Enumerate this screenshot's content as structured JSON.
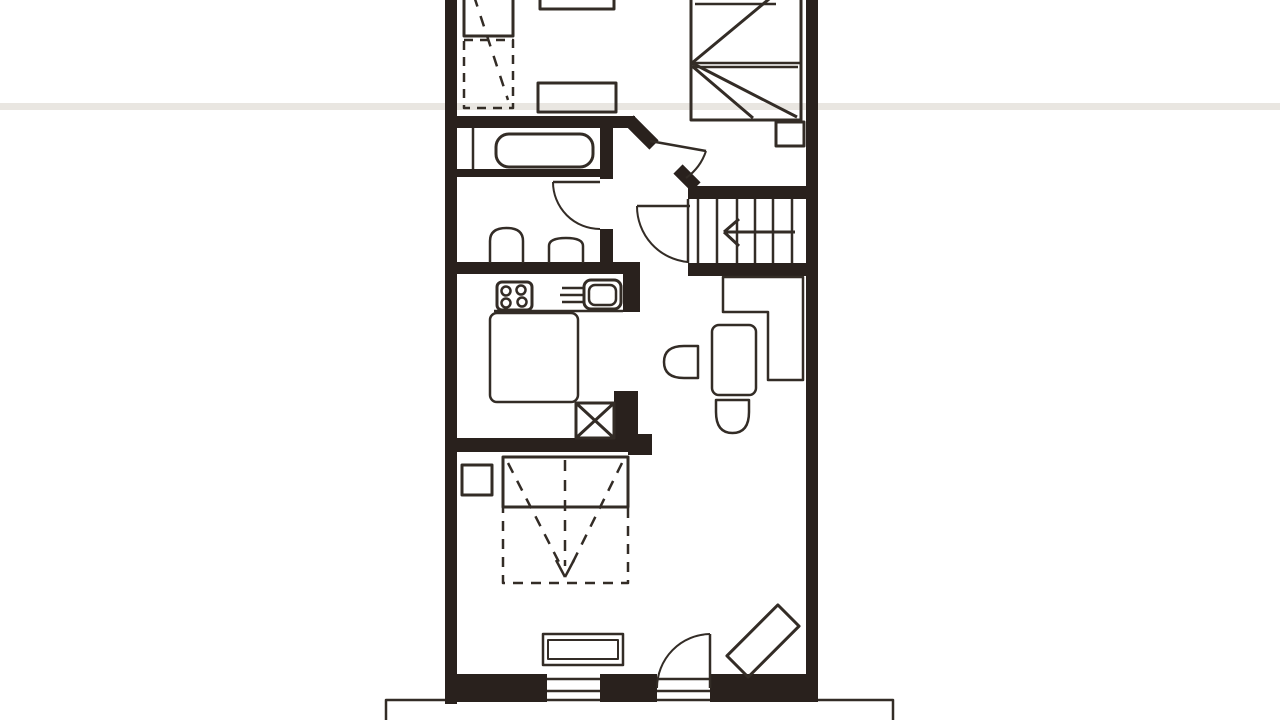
{
  "document": {
    "kind": "scanned hand-drawn floor plan, upper storey, no text labels",
    "rooms": [
      "bedroom-top-left",
      "bedroom-top-right",
      "bathroom",
      "wc",
      "kitchen",
      "stair-hall",
      "dining-nook",
      "bedroom-lower",
      "balcony"
    ]
  },
  "floorplan": {
    "canvas": {
      "width": 1280,
      "height": 720,
      "background": "#ffffff"
    },
    "style": {
      "wall": "#29211d",
      "ink": "#332c26",
      "artifact": "#e9e6e1"
    },
    "shapes": [
      {
        "name": "scan-artifact-band",
        "type": "rect",
        "x": 0,
        "y": 103,
        "width": 1280,
        "height": 7,
        "fill": "#e9e6e1",
        "stroke": "none"
      },
      {
        "name": "balcony-outline",
        "type": "path",
        "d": "M386,720 L386,700 L893,700 L893,720",
        "w": 2.5
      },
      {
        "name": "left-wall",
        "type": "rect",
        "x": 445,
        "y": 0,
        "width": 12,
        "height": 704,
        "fill": "wall",
        "stroke": "none"
      },
      {
        "name": "right-wall",
        "type": "rect",
        "x": 806,
        "y": 0,
        "width": 12,
        "height": 702,
        "fill": "wall",
        "stroke": "none"
      },
      {
        "name": "top-left-room-bottom-wall",
        "type": "rect",
        "x": 445,
        "y": 116,
        "width": 190,
        "height": 12,
        "fill": "wall",
        "stroke": "none"
      },
      {
        "name": "hall-diagonal-wall-upper",
        "type": "line",
        "x1": 629,
        "y1": 120,
        "x2": 654,
        "y2": 145,
        "w": 13,
        "c": "wall"
      },
      {
        "name": "hall-diagonal-wall-lower",
        "type": "line",
        "x1": 678,
        "y1": 169,
        "x2": 696,
        "y2": 187,
        "w": 13,
        "c": "wall"
      },
      {
        "name": "stairwell-top-wall",
        "type": "rect",
        "x": 688,
        "y": 186,
        "width": 130,
        "height": 13,
        "fill": "wall",
        "stroke": "none"
      },
      {
        "name": "stairwell-bottom-wall",
        "type": "rect",
        "x": 688,
        "y": 263,
        "width": 130,
        "height": 13,
        "fill": "wall",
        "stroke": "none"
      },
      {
        "name": "bathroom-side-wall-upper",
        "type": "rect",
        "x": 600,
        "y": 122,
        "width": 13,
        "height": 57,
        "fill": "wall",
        "stroke": "none"
      },
      {
        "name": "bathroom-side-wall-lower",
        "type": "rect",
        "x": 600,
        "y": 229,
        "width": 13,
        "height": 35,
        "fill": "wall",
        "stroke": "none"
      },
      {
        "name": "tub-base-wall",
        "type": "rect",
        "x": 455,
        "y": 169,
        "width": 146,
        "height": 8,
        "fill": "wall",
        "stroke": "none"
      },
      {
        "name": "wc-kitchen-wall",
        "type": "rect",
        "x": 445,
        "y": 262,
        "width": 195,
        "height": 12,
        "fill": "wall",
        "stroke": "none"
      },
      {
        "name": "kitchen-right-wall-post",
        "type": "rect",
        "x": 623,
        "y": 262,
        "width": 17,
        "height": 50,
        "fill": "wall",
        "stroke": "none"
      },
      {
        "name": "kitchen-bottom-wall",
        "type": "rect",
        "x": 445,
        "y": 438,
        "width": 200,
        "height": 14,
        "fill": "wall",
        "stroke": "none"
      },
      {
        "name": "kitchen-bottom-wall-end",
        "type": "rect",
        "x": 628,
        "y": 434,
        "width": 24,
        "height": 21,
        "fill": "wall",
        "stroke": "none"
      },
      {
        "name": "shaft-side-wall",
        "type": "rect",
        "x": 614,
        "y": 391,
        "width": 24,
        "height": 47,
        "fill": "wall",
        "stroke": "none"
      },
      {
        "name": "bottom-wall-left",
        "type": "rect",
        "x": 447,
        "y": 674,
        "width": 100,
        "height": 28,
        "fill": "wall",
        "stroke": "none"
      },
      {
        "name": "bottom-wall-mid",
        "type": "rect",
        "x": 600,
        "y": 674,
        "width": 57,
        "height": 28,
        "fill": "wall",
        "stroke": "none"
      },
      {
        "name": "bottom-wall-right",
        "type": "rect",
        "x": 710,
        "y": 674,
        "width": 98,
        "height": 28,
        "fill": "wall",
        "stroke": "none"
      },
      {
        "name": "bathroom-divider-line",
        "type": "line",
        "x1": 473,
        "y1": 128,
        "x2": 473,
        "y2": 169,
        "w": 2.5
      },
      {
        "name": "window-south-line1",
        "type": "line",
        "x1": 547,
        "y1": 679,
        "x2": 600,
        "y2": 679,
        "w": 2.5
      },
      {
        "name": "window-south-line2",
        "type": "line",
        "x1": 547,
        "y1": 691,
        "x2": 600,
        "y2": 691,
        "w": 2.5
      },
      {
        "name": "balcony-door-threshold1",
        "type": "line",
        "x1": 657,
        "y1": 679,
        "x2": 710,
        "y2": 679,
        "w": 2.5
      },
      {
        "name": "balcony-door-threshold2",
        "type": "line",
        "x1": 657,
        "y1": 691,
        "x2": 710,
        "y2": 691,
        "w": 2.5
      },
      {
        "name": "stair-tread-1",
        "type": "line",
        "x1": 698,
        "y1": 199,
        "x2": 698,
        "y2": 263,
        "w": 2.5
      },
      {
        "name": "stair-tread-2",
        "type": "line",
        "x1": 717,
        "y1": 199,
        "x2": 717,
        "y2": 263,
        "w": 2.5
      },
      {
        "name": "stair-tread-3",
        "type": "line",
        "x1": 737,
        "y1": 199,
        "x2": 737,
        "y2": 263,
        "w": 2.5
      },
      {
        "name": "stair-tread-4",
        "type": "line",
        "x1": 755,
        "y1": 199,
        "x2": 755,
        "y2": 263,
        "w": 2.5
      },
      {
        "name": "stair-tread-5",
        "type": "line",
        "x1": 773,
        "y1": 199,
        "x2": 773,
        "y2": 263,
        "w": 2.5
      },
      {
        "name": "stair-tread-6",
        "type": "line",
        "x1": 792,
        "y1": 199,
        "x2": 792,
        "y2": 263,
        "w": 2.5
      },
      {
        "name": "stair-left-edge",
        "type": "line",
        "x1": 688,
        "y1": 199,
        "x2": 688,
        "y2": 263,
        "w": 2.5
      },
      {
        "name": "stair-direction-arrow-shaft",
        "type": "line",
        "x1": 795,
        "y1": 232,
        "x2": 724,
        "y2": 232,
        "w": 3
      },
      {
        "name": "stair-arrow-barb-up",
        "type": "line",
        "x1": 724,
        "y1": 232,
        "x2": 739,
        "y2": 219,
        "w": 3
      },
      {
        "name": "stair-arrow-barb-down",
        "type": "line",
        "x1": 724,
        "y1": 232,
        "x2": 739,
        "y2": 246,
        "w": 3
      },
      {
        "name": "wc-door-leaf",
        "type": "line",
        "x1": 553,
        "y1": 182,
        "x2": 600,
        "y2": 182,
        "w": 2.5
      },
      {
        "name": "wc-door-arc",
        "type": "path",
        "d": "M553,182 A47,47 0 0 0 600,229",
        "w": 2
      },
      {
        "name": "stairs-door-leaf",
        "type": "line",
        "x1": 637,
        "y1": 206,
        "x2": 690,
        "y2": 206,
        "w": 2.5
      },
      {
        "name": "stairs-door-arc",
        "type": "path",
        "d": "M637,206 A56,56 0 0 0 688,262",
        "w": 2
      },
      {
        "name": "bedroom-door-leaf",
        "type": "line",
        "x1": 650,
        "y1": 141,
        "x2": 706,
        "y2": 151,
        "w": 2.5
      },
      {
        "name": "bedroom-door-arc",
        "type": "path",
        "d": "M706,151 A54,54 0 0 1 686,178",
        "w": 2
      },
      {
        "name": "balcony-door-leaf",
        "type": "line",
        "x1": 710,
        "y1": 634,
        "x2": 710,
        "y2": 688,
        "w": 2.5
      },
      {
        "name": "balcony-door-arc",
        "type": "path",
        "d": "M710,634 A54,54 0 0 0 657,688",
        "w": 2
      },
      {
        "name": "tl-cabinet",
        "type": "rect",
        "x": 464,
        "y": -8,
        "width": 49,
        "height": 44,
        "w": 3
      },
      {
        "name": "tl-cabinet-dashed",
        "type": "rect",
        "x": 464,
        "y": 40,
        "width": 49,
        "height": 68,
        "w": 2.5,
        "dash": [
          9,
          7
        ]
      },
      {
        "name": "tl-slope-dash-line",
        "type": "line",
        "x1": 474,
        "y1": -4,
        "x2": 508,
        "y2": 100,
        "w": 2.5,
        "dash": [
          11,
          10
        ]
      },
      {
        "name": "tl-top-table",
        "type": "rect",
        "x": 540,
        "y": -18,
        "width": 74,
        "height": 27,
        "w": 3
      },
      {
        "name": "tl-desk",
        "type": "rect",
        "x": 538,
        "y": 83,
        "width": 78,
        "height": 29,
        "w": 3
      },
      {
        "name": "double-bed",
        "type": "rect",
        "x": 691,
        "y": -40,
        "width": 110,
        "height": 160,
        "w": 3
      },
      {
        "name": "double-bed-mid-line1",
        "type": "line",
        "x1": 691,
        "y1": 63,
        "x2": 801,
        "y2": 63,
        "w": 2.5
      },
      {
        "name": "double-bed-mid-line2",
        "type": "line",
        "x1": 691,
        "y1": 67,
        "x2": 798,
        "y2": 67,
        "w": 2.5
      },
      {
        "name": "double-bed-diag-upper",
        "type": "line",
        "x1": 798,
        "y1": -25,
        "x2": 692,
        "y2": 63,
        "w": 3
      },
      {
        "name": "double-bed-diag-lower",
        "type": "line",
        "x1": 692,
        "y1": 63,
        "x2": 797,
        "y2": 117,
        "w": 3
      },
      {
        "name": "double-bed-diag-inner",
        "type": "line",
        "x1": 692,
        "y1": 66,
        "x2": 753,
        "y2": 118,
        "w": 3
      },
      {
        "name": "double-bed-blanket-line",
        "type": "line",
        "x1": 695,
        "y1": 4,
        "x2": 776,
        "y2": 4,
        "w": 2.5
      },
      {
        "name": "nightstand-top-bedroom",
        "type": "rect",
        "x": 776,
        "y": 122,
        "width": 28,
        "height": 24,
        "w": 3
      },
      {
        "name": "bathtub",
        "type": "rect",
        "x": 496,
        "y": 134,
        "width": 97,
        "height": 33,
        "rx": 13,
        "w": 3
      },
      {
        "name": "toilet",
        "type": "path",
        "d": "M490,263 L490,241 Q490,228 506.5,228 Q523,228 523,241 L523,263",
        "w": 2.5
      },
      {
        "name": "wc-sink",
        "type": "path",
        "d": "M549,263 L549,246 Q549,238 566,238 Q583,238 583,246 L583,263",
        "w": 2.5
      },
      {
        "name": "stove",
        "type": "rect",
        "x": 497,
        "y": 282,
        "width": 35,
        "height": 28,
        "rx": 5,
        "w": 3
      },
      {
        "name": "stove-burner-1",
        "type": "circle",
        "cx": 506,
        "cy": 291,
        "r": 4.5,
        "w": 2.5
      },
      {
        "name": "stove-burner-2",
        "type": "circle",
        "cx": 521,
        "cy": 290,
        "r": 4.5,
        "w": 2.5
      },
      {
        "name": "stove-burner-3",
        "type": "circle",
        "cx": 506,
        "cy": 303,
        "r": 4.5,
        "w": 2.5
      },
      {
        "name": "stove-burner-4",
        "type": "circle",
        "cx": 522,
        "cy": 302,
        "r": 4.5,
        "w": 2.5
      },
      {
        "name": "kitchen-sink",
        "type": "rect",
        "x": 584,
        "y": 280,
        "width": 37,
        "height": 29,
        "rx": 7,
        "w": 3
      },
      {
        "name": "kitchen-sink-basin",
        "type": "rect",
        "x": 589,
        "y": 285,
        "width": 27,
        "height": 20,
        "rx": 6,
        "w": 2.5
      },
      {
        "name": "drainer-line-1",
        "type": "line",
        "x1": 562,
        "y1": 288,
        "x2": 583,
        "y2": 288,
        "w": 2.5
      },
      {
        "name": "drainer-line-2",
        "type": "line",
        "x1": 560,
        "y1": 295,
        "x2": 583,
        "y2": 295,
        "w": 2.5
      },
      {
        "name": "drainer-line-3",
        "type": "line",
        "x1": 562,
        "y1": 302,
        "x2": 583,
        "y2": 302,
        "w": 2.5
      },
      {
        "name": "counter-edge",
        "type": "line",
        "x1": 494,
        "y1": 311,
        "x2": 623,
        "y2": 311,
        "w": 2.5
      },
      {
        "name": "kitchen-table",
        "type": "rect",
        "x": 490,
        "y": 313,
        "width": 88,
        "height": 89,
        "rx": 7,
        "w": 2.5
      },
      {
        "name": "shaft-box",
        "type": "rect",
        "x": 576,
        "y": 403,
        "width": 38,
        "height": 35,
        "w": 3
      },
      {
        "name": "shaft-x1",
        "type": "line",
        "x1": 576,
        "y1": 403,
        "x2": 614,
        "y2": 438,
        "w": 3
      },
      {
        "name": "shaft-x2",
        "type": "line",
        "x1": 614,
        "y1": 403,
        "x2": 576,
        "y2": 438,
        "w": 3
      },
      {
        "name": "corner-bench",
        "type": "polygon",
        "points": "723,277 803,277 803,380 768,380 768,312 723,312",
        "w": 2.5
      },
      {
        "name": "dining-table",
        "type": "rect",
        "x": 712,
        "y": 325,
        "width": 44,
        "height": 70,
        "rx": 7,
        "w": 2.5
      },
      {
        "name": "dining-chair-left",
        "type": "path",
        "d": "M698,346 L698,378 L684,378 Q664,378 664,362 Q664,346 684,346 Z",
        "w": 2.5
      },
      {
        "name": "dining-chair-bottom",
        "type": "path",
        "d": "M716,400 L749,400 L749,412 Q749,433 732.5,433 Q716,433 716,412 Z",
        "w": 2.5
      },
      {
        "name": "nightstand-lower-bedroom",
        "type": "rect",
        "x": 462,
        "y": 465,
        "width": 30,
        "height": 30,
        "w": 3
      },
      {
        "name": "lower-bed",
        "type": "rect",
        "x": 503,
        "y": 457,
        "width": 125,
        "height": 50,
        "w": 3
      },
      {
        "name": "lower-bed-slope-dashed",
        "type": "rect",
        "x": 503,
        "y": 507,
        "width": 125,
        "height": 76,
        "w": 2.5,
        "dash": [
          10,
          8
        ]
      },
      {
        "name": "slope-dash-v-left",
        "type": "line",
        "x1": 508,
        "y1": 463,
        "x2": 562,
        "y2": 568,
        "w": 2.5,
        "dash": [
          11,
          9
        ]
      },
      {
        "name": "slope-dash-v-right",
        "type": "line",
        "x1": 622,
        "y1": 463,
        "x2": 570,
        "y2": 568,
        "w": 2.5,
        "dash": [
          11,
          9
        ]
      },
      {
        "name": "slope-dash-center",
        "type": "line",
        "x1": 565,
        "y1": 460,
        "x2": 565,
        "y2": 566,
        "w": 2.5,
        "dash": [
          11,
          9
        ]
      },
      {
        "name": "slope-arrow-barb-left",
        "type": "line",
        "x1": 565,
        "y1": 577,
        "x2": 556,
        "y2": 560,
        "w": 2.5
      },
      {
        "name": "slope-arrow-barb-right",
        "type": "line",
        "x1": 565,
        "y1": 577,
        "x2": 574,
        "y2": 560,
        "w": 2.5
      },
      {
        "name": "sideboard",
        "type": "rect",
        "x": 543,
        "y": 634,
        "width": 80,
        "height": 31,
        "w": 2.5
      },
      {
        "name": "sideboard-inner",
        "type": "rect",
        "x": 548,
        "y": 640,
        "width": 70,
        "height": 19,
        "w": 2
      },
      {
        "name": "lounge-chair-diagonal",
        "type": "rect",
        "x": -36,
        "y": -15,
        "width": 72,
        "height": 30,
        "w": 3,
        "transform": "translate(763,641) rotate(-45)"
      }
    ]
  }
}
